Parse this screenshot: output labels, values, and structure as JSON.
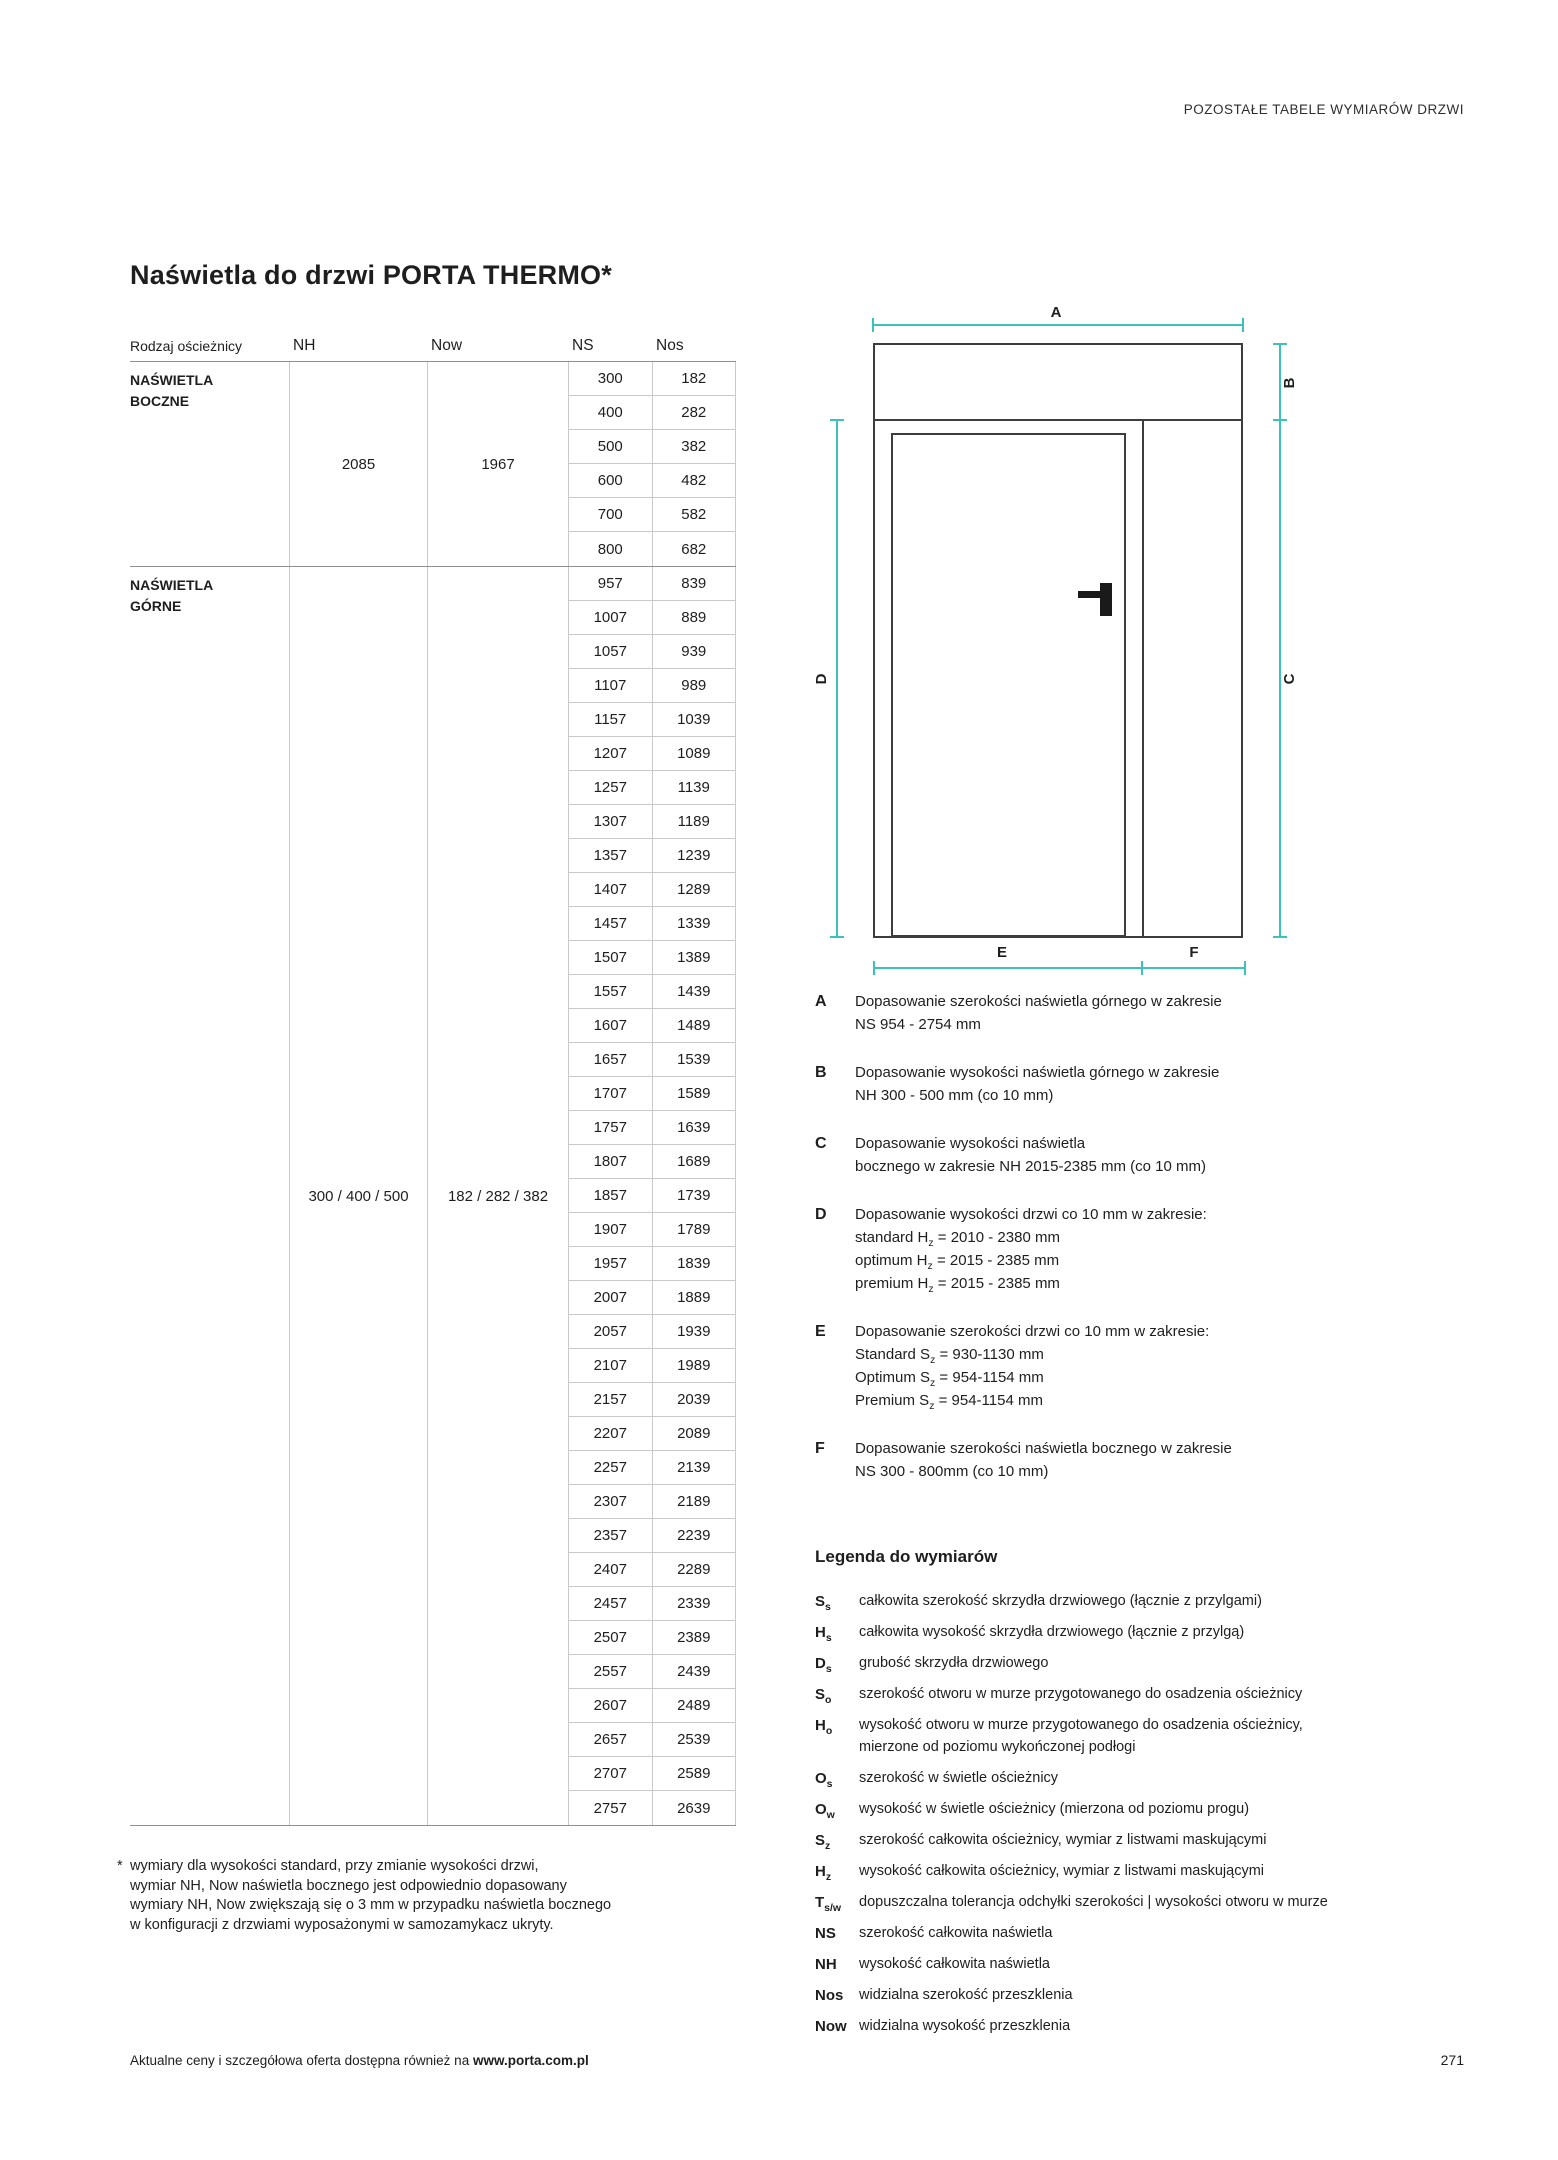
{
  "page": {
    "running_header": "POZOSTAŁE TABELE WYMIARÓW DRZWI",
    "title": "Naświetla do drzwi PORTA THERMO*",
    "footer_text": "Aktualne ceny i szczegółowa oferta dostępna również na ",
    "footer_link": "www.porta.com.pl",
    "page_number": "271"
  },
  "table": {
    "columns": [
      "Rodzaj ościeżnicy",
      "NH",
      "Now",
      "NS",
      "Nos"
    ],
    "groups": [
      {
        "label": "NAŚWIETLA\nBOCZNE",
        "nh": "2085",
        "now": "1967",
        "rows": [
          [
            300,
            182
          ],
          [
            400,
            282
          ],
          [
            500,
            382
          ],
          [
            600,
            482
          ],
          [
            700,
            582
          ],
          [
            800,
            682
          ]
        ]
      },
      {
        "label": "NAŚWIETLA\nGÓRNE",
        "nh": "300 / 400 / 500",
        "now": "182 / 282 / 382",
        "rows": [
          [
            957,
            839
          ],
          [
            1007,
            889
          ],
          [
            1057,
            939
          ],
          [
            1107,
            989
          ],
          [
            1157,
            1039
          ],
          [
            1207,
            1089
          ],
          [
            1257,
            1139
          ],
          [
            1307,
            1189
          ],
          [
            1357,
            1239
          ],
          [
            1407,
            1289
          ],
          [
            1457,
            1339
          ],
          [
            1507,
            1389
          ],
          [
            1557,
            1439
          ],
          [
            1607,
            1489
          ],
          [
            1657,
            1539
          ],
          [
            1707,
            1589
          ],
          [
            1757,
            1639
          ],
          [
            1807,
            1689
          ],
          [
            1857,
            1739
          ],
          [
            1907,
            1789
          ],
          [
            1957,
            1839
          ],
          [
            2007,
            1889
          ],
          [
            2057,
            1939
          ],
          [
            2107,
            1989
          ],
          [
            2157,
            2039
          ],
          [
            2207,
            2089
          ],
          [
            2257,
            2139
          ],
          [
            2307,
            2189
          ],
          [
            2357,
            2239
          ],
          [
            2407,
            2289
          ],
          [
            2457,
            2339
          ],
          [
            2507,
            2389
          ],
          [
            2557,
            2439
          ],
          [
            2607,
            2489
          ],
          [
            2657,
            2539
          ],
          [
            2707,
            2589
          ],
          [
            2757,
            2639
          ]
        ]
      }
    ]
  },
  "footnote": {
    "marker": "*",
    "lines": [
      "wymiary dla wysokości standard, przy zmianie wysokości drzwi,",
      "wymiar NH, Now naświetla bocznego jest odpowiednio dopasowany",
      "wymiary NH, Now zwiększają się o 3 mm w przypadku naświetla bocznego",
      "w konfiguracji z drzwiami wyposażonymi w samozamykacz ukryty."
    ]
  },
  "diagram": {
    "labels": {
      "a": "A",
      "b": "B",
      "c": "C",
      "d": "D",
      "e": "E",
      "f": "F"
    },
    "accent_color": "#3cc2b8",
    "outline_color": "#3d3d3d"
  },
  "dim_legend": [
    {
      "key": "A",
      "lines": [
        "Dopasowanie szerokości naświetla górnego w zakresie",
        "NS 954 - 2754 mm"
      ]
    },
    {
      "key": "B",
      "lines": [
        "Dopasowanie wysokości naświetla górnego w zakresie",
        "NH 300 - 500 mm (co 10 mm)"
      ]
    },
    {
      "key": "C",
      "lines": [
        "Dopasowanie wysokości naświetla",
        "bocznego w zakresie NH 2015-2385 mm (co 10 mm)"
      ]
    },
    {
      "key": "D",
      "lines": [
        "Dopasowanie wysokości drzwi co 10 mm w zakresie:",
        "standard H~z~ = 2010 - 2380 mm",
        "optimum H~z~ = 2015 - 2385 mm",
        "premium H~z~ = 2015 - 2385 mm"
      ]
    },
    {
      "key": "E",
      "lines": [
        "Dopasowanie szerokości drzwi co 10 mm w zakresie:",
        "Standard S~z~ = 930-1130 mm",
        "Optimum S~z~ = 954-1154 mm",
        "Premium S~z~ = 954-1154 mm"
      ]
    },
    {
      "key": "F",
      "lines": [
        "Dopasowanie szerokości naświetla bocznego w zakresie",
        "NS 300 - 800mm (co 10 mm)"
      ]
    }
  ],
  "symbol_legend": {
    "title": "Legenda do wymiarów",
    "items": [
      {
        "sym": "S~s~",
        "desc": "całkowita szerokość skrzydła drzwiowego (łącznie z przylgami)"
      },
      {
        "sym": "H~s~",
        "desc": "całkowita wysokość skrzydła drzwiowego (łącznie z przylgą)"
      },
      {
        "sym": "D~s~",
        "desc": "grubość skrzydła drzwiowego"
      },
      {
        "sym": "S~o~",
        "desc": "szerokość otworu w murze przygotowanego do osadzenia ościeżnicy"
      },
      {
        "sym": "H~o~",
        "desc": "wysokość otworu w murze przygotowanego do osadzenia ościeżnicy,\nmierzone od poziomu wykończonej podłogi"
      },
      {
        "sym": "O~s~",
        "desc": "szerokość w świetle ościeżnicy"
      },
      {
        "sym": "O~w~",
        "desc": "wysokość w świetle ościeżnicy (mierzona od poziomu progu)"
      },
      {
        "sym": "S~z~",
        "desc": "szerokość całkowita ościeżnicy, wymiar z listwami maskującymi"
      },
      {
        "sym": "H~z~",
        "desc": "wysokość całkowita ościeżnicy, wymiar z listwami maskującymi"
      },
      {
        "sym": "T~s/w~",
        "desc": "dopuszczalna tolerancja odchyłki szerokości | wysokości otworu w murze"
      },
      {
        "sym": "NS",
        "desc": "szerokość całkowita naświetla"
      },
      {
        "sym": "NH",
        "desc": "wysokość całkowita naświetla"
      },
      {
        "sym": "Nos",
        "desc": "widzialna szerokość przeszklenia"
      },
      {
        "sym": "Now",
        "desc": "widzialna wysokość przeszklenia"
      }
    ]
  }
}
